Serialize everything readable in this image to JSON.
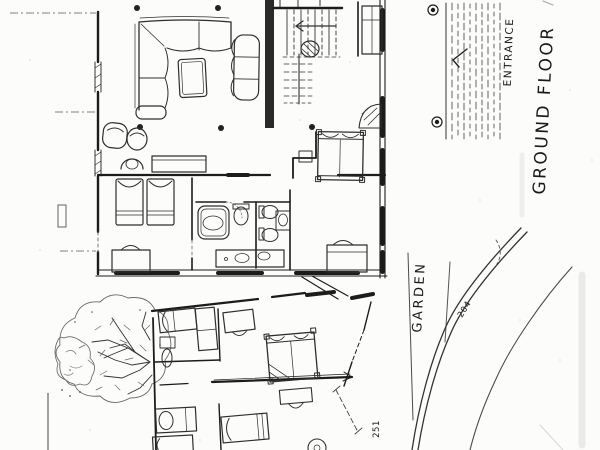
{
  "sheet": {
    "paper_color": "#fcfcfb",
    "ink_color": "#1c1c1c",
    "pencil_color": "#555555"
  },
  "labels": {
    "ground_floor": "GROUND FLOOR",
    "entrance": "ENTRANCE",
    "garden": "GARDEN",
    "path_dimension": "204",
    "wing_dimension": "251"
  }
}
